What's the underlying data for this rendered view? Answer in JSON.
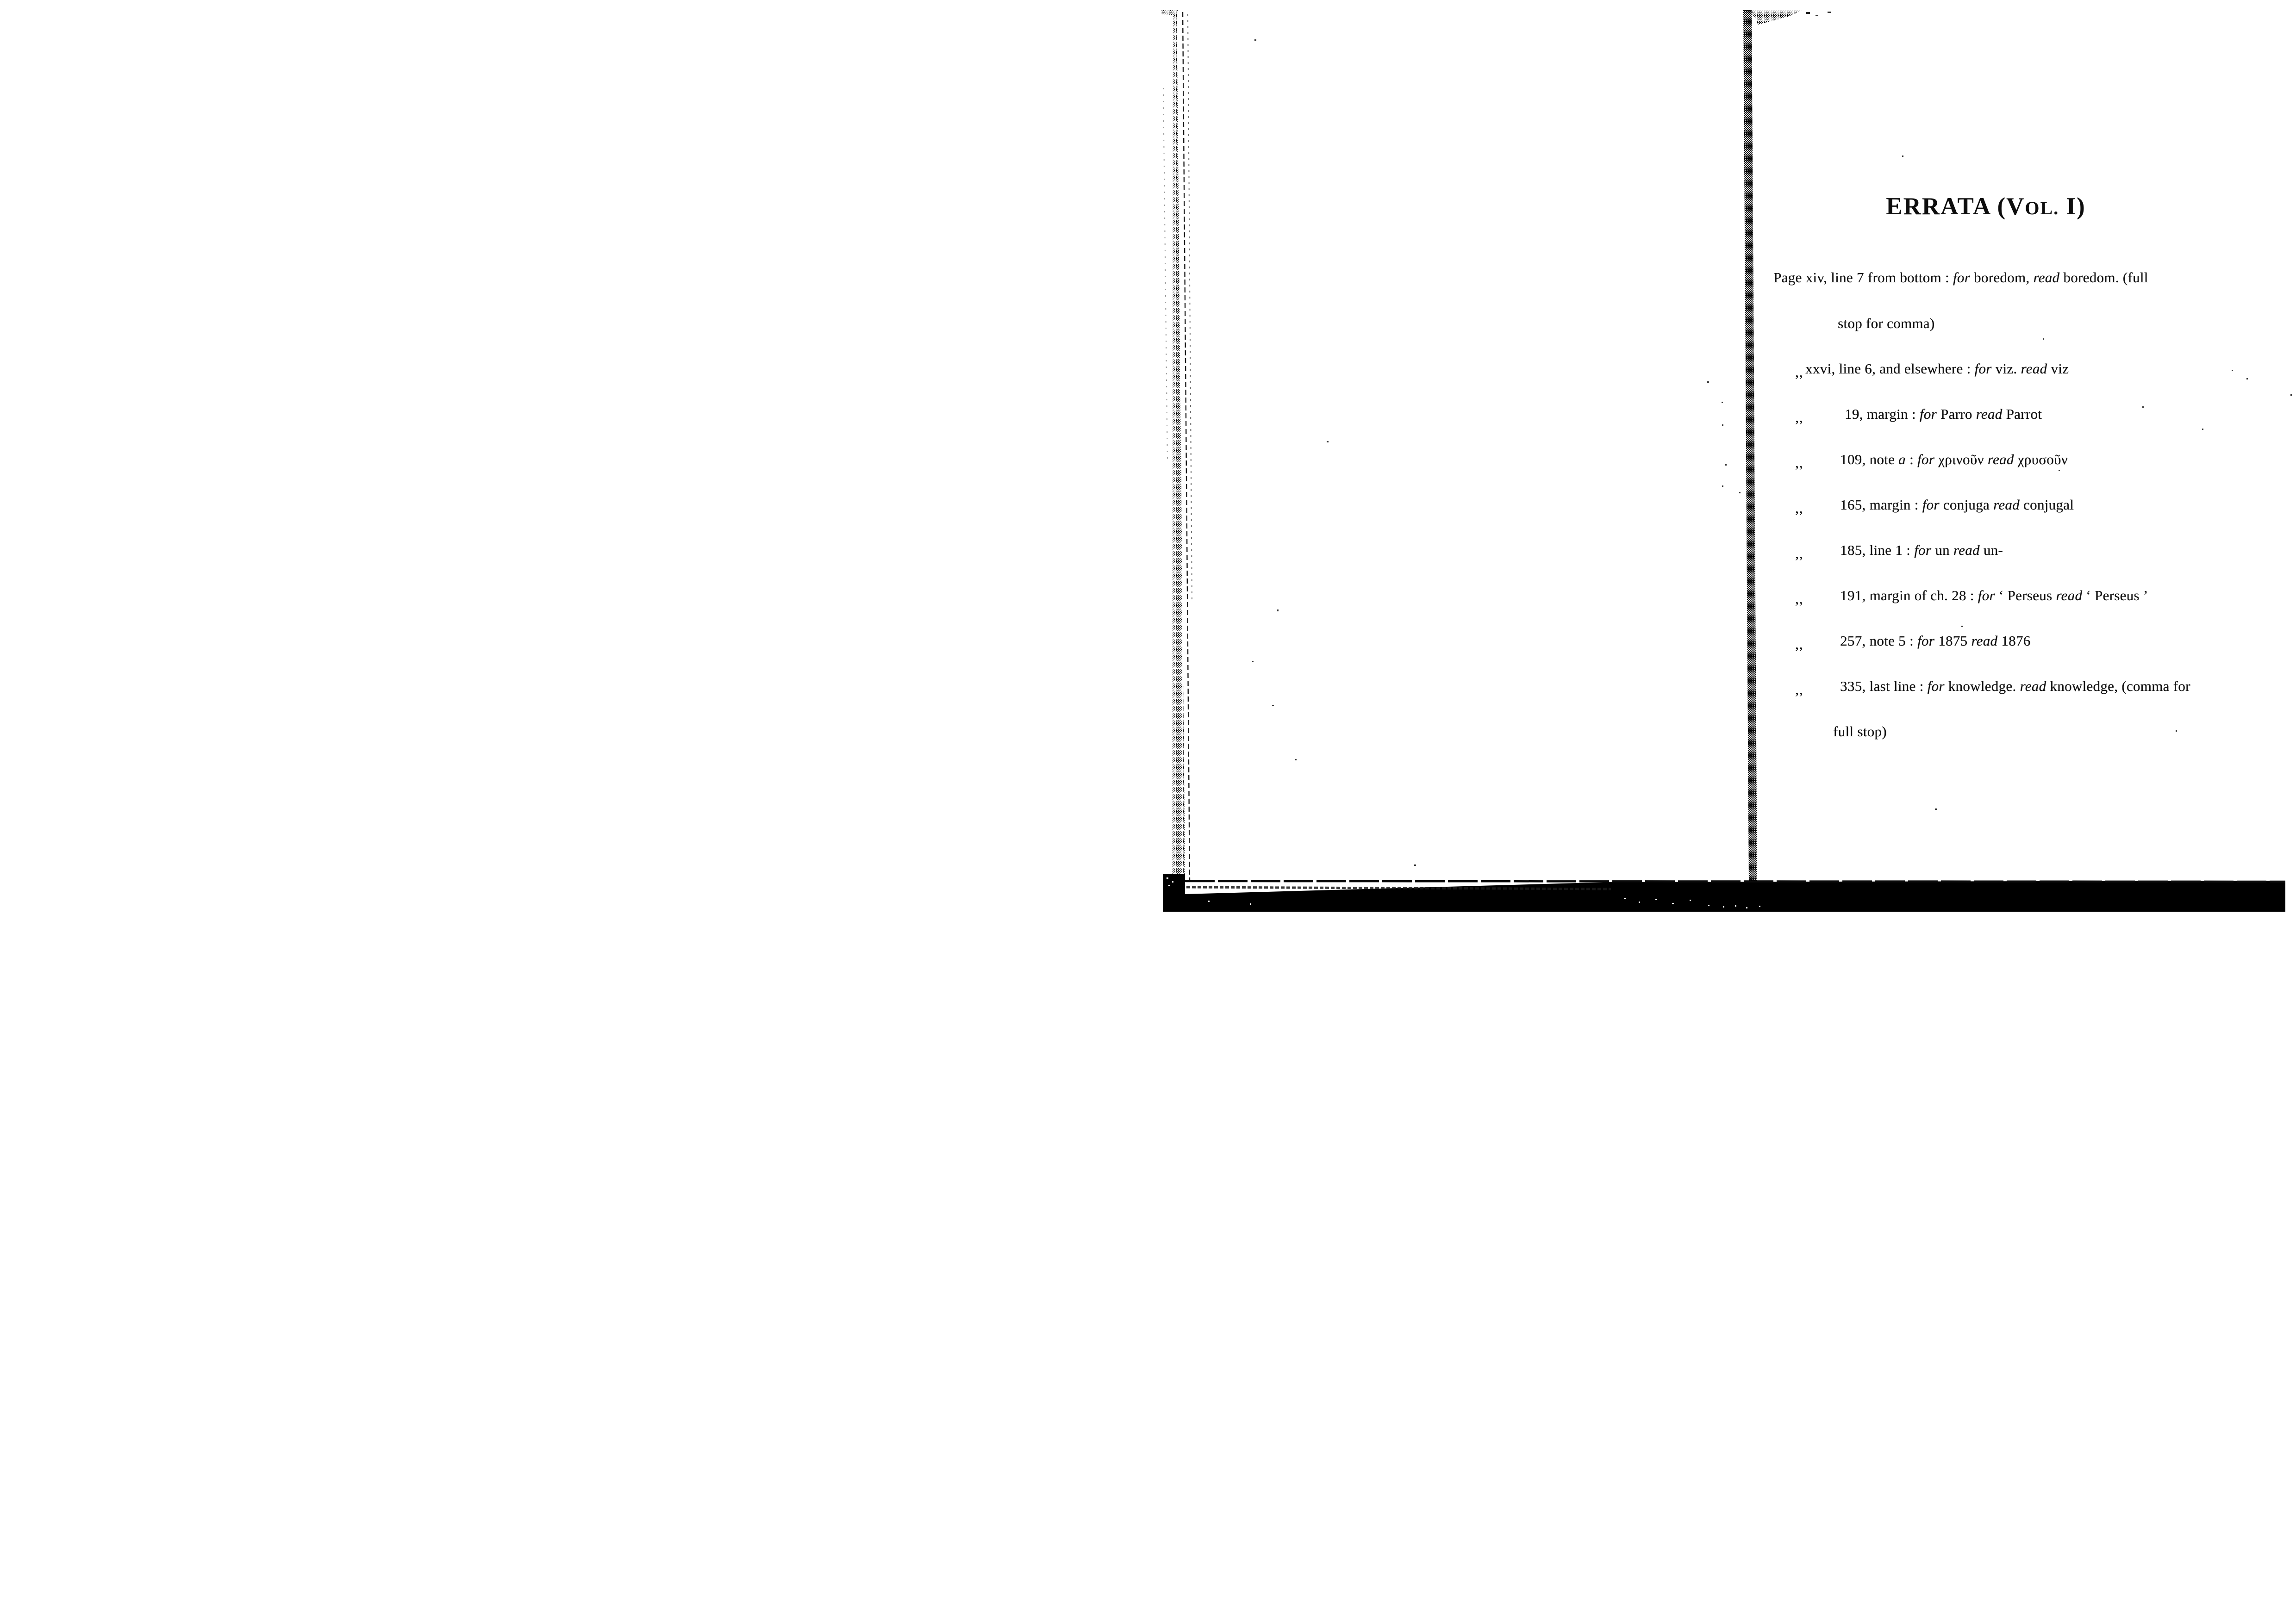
{
  "page": {
    "title": {
      "part1": "ERRATA (V",
      "part2": "OL.",
      "part3": " I)"
    }
  },
  "errata": {
    "lines": [
      {
        "segments": [
          {
            "text": "Page xiv, line 7 from bottom : "
          },
          {
            "text": "for",
            "italic": true
          },
          {
            "text": " boredom, "
          },
          {
            "text": "read",
            "italic": true
          },
          {
            "text": " boredom. (full"
          }
        ]
      },
      {
        "continuation": "stop for comma)"
      },
      {
        "prefix": ",,",
        "segments": [
          {
            "text": "xxvi, line 6, and elsewhere : "
          },
          {
            "text": "for",
            "italic": true
          },
          {
            "text": " viz. "
          },
          {
            "text": "read",
            "italic": true
          },
          {
            "text": " viz"
          }
        ]
      },
      {
        "prefix": ",,",
        "segments": [
          {
            "text": "19, margin : "
          },
          {
            "text": "for",
            "italic": true
          },
          {
            "text": " Parro "
          },
          {
            "text": "read",
            "italic": true
          },
          {
            "text": " Parrot"
          }
        ]
      },
      {
        "prefix": ",,",
        "segments": [
          {
            "text": "109, note "
          },
          {
            "text": "a",
            "italic": true
          },
          {
            "text": " : "
          },
          {
            "text": "for",
            "italic": true
          },
          {
            "text": " χρινοῦν "
          },
          {
            "text": "read",
            "italic": true
          },
          {
            "text": " χρυσοῦν"
          }
        ]
      },
      {
        "prefix": ",,",
        "segments": [
          {
            "text": "165, margin : "
          },
          {
            "text": "for",
            "italic": true
          },
          {
            "text": " conjuga "
          },
          {
            "text": "read",
            "italic": true
          },
          {
            "text": " conjugal"
          }
        ]
      },
      {
        "prefix": ",,",
        "segments": [
          {
            "text": "185, line 1 : "
          },
          {
            "text": "for",
            "italic": true
          },
          {
            "text": " un "
          },
          {
            "text": "read",
            "italic": true
          },
          {
            "text": " un-"
          }
        ]
      },
      {
        "prefix": ",,",
        "segments": [
          {
            "text": "191, margin of ch. 28 : "
          },
          {
            "text": "for",
            "italic": true
          },
          {
            "text": " ‘ Perseus "
          },
          {
            "text": "read",
            "italic": true
          },
          {
            "text": " ‘ Perseus ’"
          }
        ]
      },
      {
        "prefix": ",,",
        "segments": [
          {
            "text": "257, note 5 : "
          },
          {
            "text": "for",
            "italic": true
          },
          {
            "text": " 1875 "
          },
          {
            "text": "read",
            "italic": true
          },
          {
            "text": " 1876"
          }
        ]
      },
      {
        "prefix": ",,",
        "segments": [
          {
            "text": "335, last line : "
          },
          {
            "text": "for",
            "italic": true
          },
          {
            "text": " knowledge. "
          },
          {
            "text": "read",
            "italic": true
          },
          {
            "text": " knowledge, (comma for"
          }
        ]
      },
      {
        "continuation": "full stop)"
      }
    ]
  },
  "artifacts": {
    "paper_color": "#ffffff",
    "ink_color": "#101010",
    "bar_color": "#000000",
    "edge_color": "#1a1a1a"
  }
}
